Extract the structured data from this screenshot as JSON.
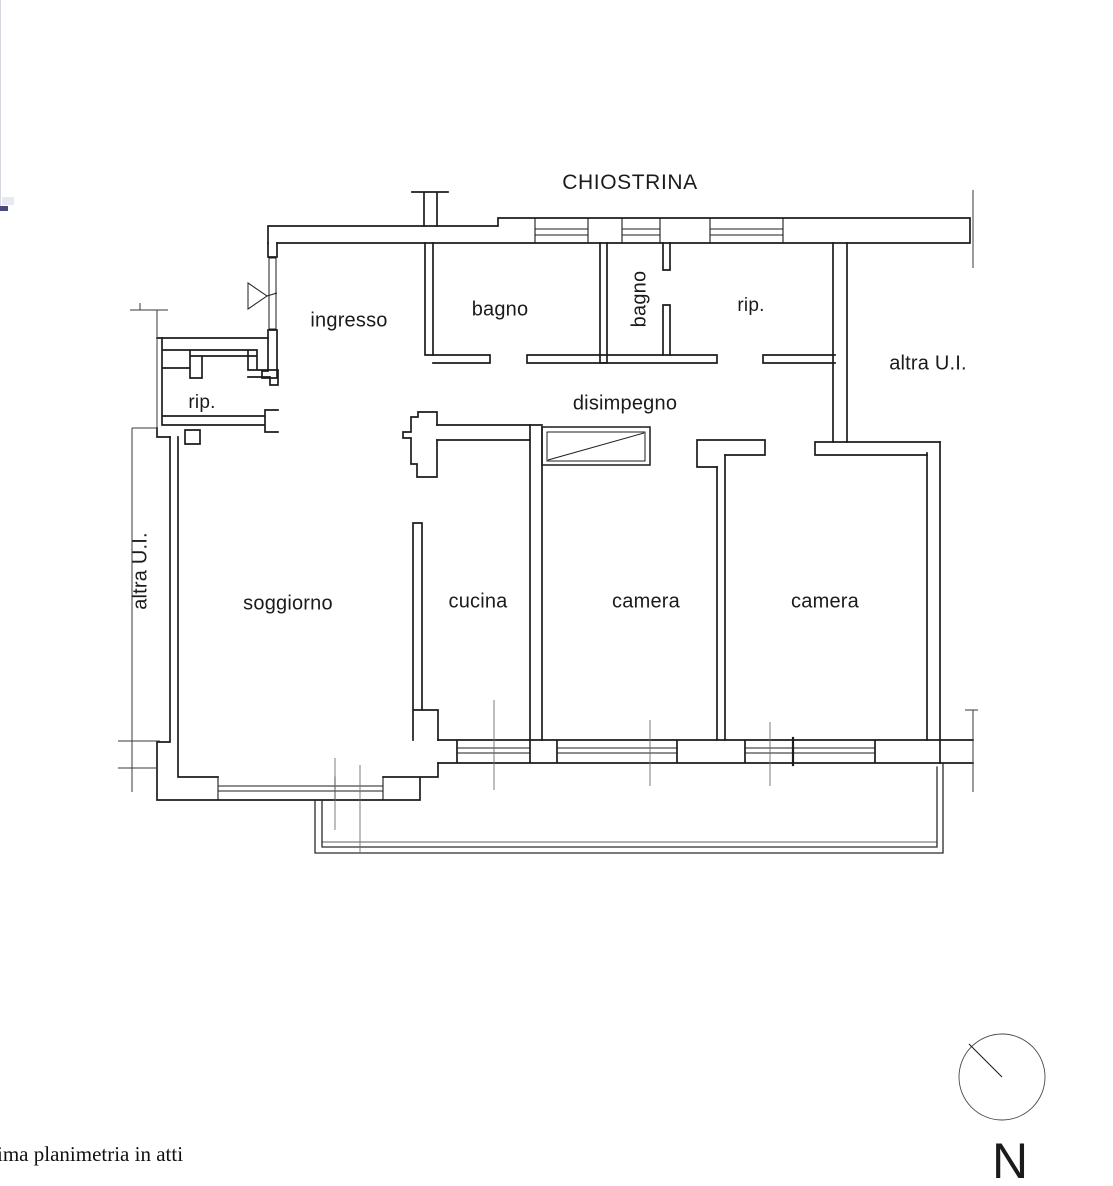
{
  "drawing": {
    "title": "CHIOSTRINA",
    "room_labels": {
      "ingresso": "ingresso",
      "bagno_1": "bagno",
      "bagno_2": "bagno",
      "rip_top": "rip.",
      "rip_left": "rip.",
      "disimpegno": "disimpegno",
      "soggiorno": "soggiorno",
      "cucina": "cucina",
      "camera_1": "camera",
      "camera_2": "camera",
      "altra_ui_left": "altra U.I.",
      "altra_ui_right": "altra U.I."
    },
    "compass": {
      "label": "N"
    },
    "footer_note": "ima planimetria in atti",
    "colors": {
      "wall_line": "#1c1c1c",
      "thin_line": "#6f6f6f",
      "edge_mark_blue": "#4a4a7c"
    }
  }
}
